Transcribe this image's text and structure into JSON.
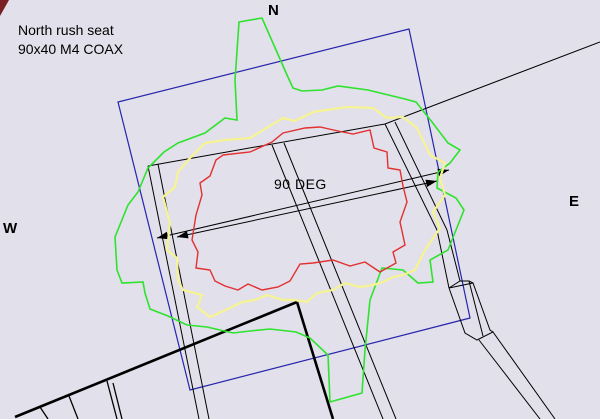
{
  "canvas": {
    "width": 600,
    "height": 419,
    "background": "#e2e0ea"
  },
  "labels": {
    "title_line1": "North rush seat",
    "title_line2": "90x40 M4 COAX",
    "north": "N",
    "east": "E",
    "west": "W",
    "dimension": "90 DEG"
  },
  "colors": {
    "line": "#000000",
    "boundary": "#2626ac",
    "outer_contour": "#2ee32e",
    "mid_contour": "#f6f492",
    "inner_contour": "#e33030",
    "corner_mark": "#7a2024"
  },
  "geometry": {
    "blue_rect": [
      [
        118,
        102
      ],
      [
        409,
        29
      ],
      [
        470,
        318
      ],
      [
        190,
        390
      ]
    ],
    "thin_lines": [
      [
        [
          600,
          42
        ],
        [
          385,
          124
        ],
        [
          148,
          166
        ]
      ],
      [
        [
          148,
          166
        ],
        [
          199,
          419
        ]
      ],
      [
        [
          158,
          164
        ],
        [
          209,
          419
        ]
      ],
      [
        [
          272,
          145
        ],
        [
          383,
          419
        ]
      ],
      [
        [
          284,
          143
        ],
        [
          396,
          419
        ]
      ],
      [
        [
          385,
          124
        ],
        [
          437,
          230
        ],
        [
          449,
          288
        ]
      ],
      [
        [
          395,
          122
        ],
        [
          447,
          230
        ],
        [
          460,
          281
        ]
      ],
      [
        [
          449,
          288
        ],
        [
          460,
          281
        ],
        [
          469,
          281
        ],
        [
          473,
          283
        ]
      ],
      [
        [
          449,
          288
        ],
        [
          473,
          283
        ],
        [
          490,
          330
        ],
        [
          493,
          332
        ],
        [
          477,
          340
        ],
        [
          465,
          333
        ],
        [
          449,
          288
        ]
      ],
      [
        [
          469,
          281
        ],
        [
          483,
          336
        ]
      ],
      [
        [
          493,
          332
        ],
        [
          555,
          419
        ]
      ],
      [
        [
          479,
          340
        ],
        [
          540,
          419
        ]
      ]
    ],
    "thick_lines": [
      [
        [
          297,
          302
        ],
        [
          15,
          417
        ]
      ],
      [
        [
          297,
          302
        ],
        [
          333,
          419
        ]
      ]
    ],
    "tick_lines": [
      [
        [
          40,
          407
        ],
        [
          48,
          419
        ]
      ],
      [
        [
          69,
          396
        ],
        [
          78,
          419
        ]
      ],
      [
        [
          107,
          381
        ],
        [
          117,
          419
        ]
      ],
      [
        [
          113,
          383
        ],
        [
          122,
          419
        ]
      ]
    ],
    "corner_mark": [
      [
        0,
        0
      ],
      [
        9,
        0
      ],
      [
        0,
        16
      ]
    ],
    "dimension_lines": [
      [
        157,
        238,
        449,
        170
      ],
      [
        177,
        237,
        437,
        181
      ]
    ],
    "contours": [
      {
        "name": "outer-green",
        "color_key": "outer_contour",
        "width": 1.6,
        "points": [
          [
            178,
            143
          ],
          [
            205,
            133
          ],
          [
            225,
            118
          ],
          [
            237,
            120
          ],
          [
            235,
            80
          ],
          [
            239,
            22
          ],
          [
            262,
            18
          ],
          [
            287,
            75
          ],
          [
            293,
            88
          ],
          [
            302,
            91
          ],
          [
            322,
            90
          ],
          [
            338,
            86
          ],
          [
            368,
            90
          ],
          [
            405,
            99
          ],
          [
            416,
            102
          ],
          [
            432,
            122
          ],
          [
            448,
            143
          ],
          [
            460,
            150
          ],
          [
            450,
            163
          ],
          [
            438,
            172
          ],
          [
            437,
            188
          ],
          [
            456,
            198
          ],
          [
            464,
            210
          ],
          [
            448,
            250
          ],
          [
            430,
            260
          ],
          [
            433,
            282
          ],
          [
            418,
            283
          ],
          [
            403,
            270
          ],
          [
            382,
            268
          ],
          [
            370,
            300
          ],
          [
            365,
            350
          ],
          [
            362,
            393
          ],
          [
            330,
            402
          ],
          [
            328,
            355
          ],
          [
            310,
            338
          ],
          [
            296,
            332
          ],
          [
            270,
            329
          ],
          [
            250,
            331
          ],
          [
            233,
            333
          ],
          [
            207,
            327
          ],
          [
            187,
            325
          ],
          [
            168,
            316
          ],
          [
            150,
            309
          ],
          [
            145,
            293
          ],
          [
            143,
            282
          ],
          [
            122,
            283
          ],
          [
            117,
            270
          ],
          [
            115,
            237
          ],
          [
            128,
            205
          ],
          [
            138,
            192
          ],
          [
            148,
            168
          ],
          [
            164,
            152
          ]
        ]
      },
      {
        "name": "mid-yellow",
        "color_key": "mid_contour",
        "width": 2.2,
        "points": [
          [
            205,
            143
          ],
          [
            225,
            140
          ],
          [
            250,
            138
          ],
          [
            263,
            130
          ],
          [
            283,
            118
          ],
          [
            295,
            121
          ],
          [
            313,
            112
          ],
          [
            347,
            107
          ],
          [
            373,
            108
          ],
          [
            387,
            118
          ],
          [
            403,
            117
          ],
          [
            417,
            128
          ],
          [
            430,
            155
          ],
          [
            445,
            163
          ],
          [
            440,
            178
          ],
          [
            445,
            195
          ],
          [
            433,
            212
          ],
          [
            440,
            228
          ],
          [
            425,
            250
          ],
          [
            415,
            270
          ],
          [
            403,
            275
          ],
          [
            393,
            277
          ],
          [
            383,
            282
          ],
          [
            373,
            285
          ],
          [
            360,
            287
          ],
          [
            345,
            283
          ],
          [
            333,
            290
          ],
          [
            317,
            293
          ],
          [
            307,
            302
          ],
          [
            295,
            300
          ],
          [
            283,
            300
          ],
          [
            267,
            295
          ],
          [
            255,
            300
          ],
          [
            242,
            302
          ],
          [
            230,
            308
          ],
          [
            210,
            317
          ],
          [
            197,
            307
          ],
          [
            202,
            295
          ],
          [
            183,
            290
          ],
          [
            178,
            280
          ],
          [
            177,
            258
          ],
          [
            167,
            250
          ],
          [
            170,
            223
          ],
          [
            163,
            197
          ],
          [
            175,
            187
          ],
          [
            178,
            172
          ],
          [
            190,
            158
          ]
        ]
      },
      {
        "name": "inner-red",
        "color_key": "inner_contour",
        "width": 1.4,
        "points": [
          [
            223,
            155
          ],
          [
            250,
            152
          ],
          [
            272,
            142
          ],
          [
            283,
            133
          ],
          [
            305,
            128
          ],
          [
            320,
            127
          ],
          [
            338,
            131
          ],
          [
            353,
            134
          ],
          [
            370,
            130
          ],
          [
            374,
            148
          ],
          [
            387,
            152
          ],
          [
            388,
            168
          ],
          [
            400,
            170
          ],
          [
            403,
            186
          ],
          [
            407,
            202
          ],
          [
            400,
            222
          ],
          [
            405,
            245
          ],
          [
            393,
            252
          ],
          [
            396,
            263
          ],
          [
            380,
            272
          ],
          [
            365,
            262
          ],
          [
            350,
            266
          ],
          [
            333,
            260
          ],
          [
            313,
            263
          ],
          [
            300,
            264
          ],
          [
            290,
            281
          ],
          [
            278,
            287
          ],
          [
            262,
            290
          ],
          [
            248,
            284
          ],
          [
            238,
            290
          ],
          [
            225,
            286
          ],
          [
            215,
            281
          ],
          [
            210,
            270
          ],
          [
            196,
            268
          ],
          [
            198,
            252
          ],
          [
            192,
            240
          ],
          [
            196,
            215
          ],
          [
            202,
            195
          ],
          [
            200,
            183
          ],
          [
            210,
            176
          ],
          [
            216,
            160
          ]
        ]
      }
    ]
  }
}
